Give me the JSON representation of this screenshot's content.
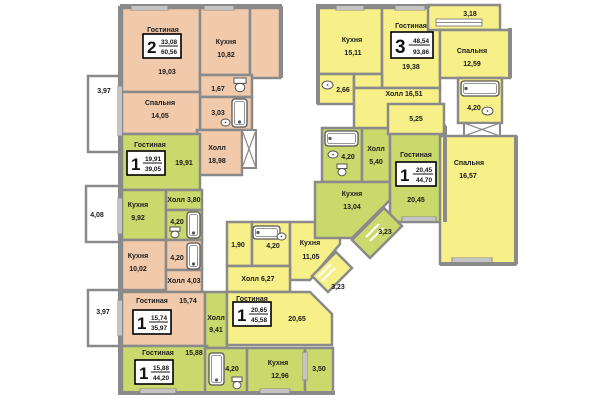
{
  "palette": {
    "wall": "#8a8a8a",
    "peach": "#f1caac",
    "green": "#c9d96b",
    "yellow": "#f7ef87",
    "white": "#ffffff",
    "text": "#1b1b1b",
    "badge_border": "#000000"
  },
  "rooms": [
    {
      "n": "balcony-397-top",
      "f": "white",
      "r": [
        88,
        76,
        32,
        76
      ],
      "labels": [
        {
          "t": "3,97",
          "x": 104,
          "y": 93
        }
      ]
    },
    {
      "n": "balcony-408",
      "f": "white",
      "r": [
        86,
        186,
        34,
        56
      ],
      "labels": [
        {
          "t": "4,08",
          "x": 97,
          "y": 217
        }
      ]
    },
    {
      "n": "balcony-397-bottom",
      "f": "white",
      "r": [
        88,
        290,
        32,
        56
      ],
      "labels": [
        {
          "t": "3,97",
          "x": 103,
          "y": 314
        }
      ]
    },
    {
      "n": "living-2room",
      "f": "peach",
      "r": [
        122,
        8,
        78,
        84
      ],
      "labels": [
        {
          "t": "Гостиная",
          "x": 163,
          "y": 32
        },
        {
          "t": "19,03",
          "x": 167,
          "y": 74
        }
      ]
    },
    {
      "n": "kitchen-2room",
      "f": "peach",
      "r": [
        200,
        8,
        50,
        67
      ],
      "labels": [
        {
          "t": "Кухня",
          "x": 226,
          "y": 44
        },
        {
          "t": "10,82",
          "x": 226,
          "y": 57
        }
      ]
    },
    {
      "n": "corner-2room",
      "f": "peach",
      "r": [
        250,
        8,
        30,
        70
      ],
      "labels": []
    },
    {
      "n": "wc-2room",
      "f": "peach",
      "r": [
        200,
        75,
        52,
        22
      ],
      "labels": [
        {
          "t": "1,67",
          "x": 218,
          "y": 91
        }
      ]
    },
    {
      "n": "bath-2room",
      "f": "peach",
      "r": [
        200,
        97,
        52,
        33
      ],
      "labels": [
        {
          "t": "3,03",
          "x": 218,
          "y": 115
        }
      ]
    },
    {
      "n": "bedroom-2room",
      "f": "peach",
      "r": [
        122,
        92,
        78,
        42
      ],
      "labels": [
        {
          "t": "Спальня",
          "x": 160,
          "y": 105
        },
        {
          "t": "14,05",
          "x": 160,
          "y": 118
        }
      ]
    },
    {
      "n": "hall-2room",
      "f": "peach",
      "r": [
        197,
        130,
        45,
        45
      ],
      "labels": [
        {
          "t": "Холл",
          "x": 217,
          "y": 150
        },
        {
          "t": "18,98",
          "x": 217,
          "y": 163
        }
      ]
    },
    {
      "n": "living-1room-a",
      "f": "green",
      "r": [
        122,
        134,
        78,
        56
      ],
      "labels": [
        {
          "t": "Гостиная",
          "x": 150,
          "y": 147
        },
        {
          "t": "19,91",
          "x": 184,
          "y": 165
        }
      ]
    },
    {
      "n": "kitchen-1room-a",
      "f": "green",
      "r": [
        122,
        190,
        44,
        50
      ],
      "labels": [
        {
          "t": "Кухня",
          "x": 138,
          "y": 207
        },
        {
          "t": "9,92",
          "x": 138,
          "y": 220
        }
      ]
    },
    {
      "n": "hall-1room-a",
      "f": "green",
      "r": [
        166,
        190,
        36,
        20
      ],
      "labels": [
        {
          "t": "Холл 3,80",
          "x": 184,
          "y": 202
        }
      ]
    },
    {
      "n": "bath-1room-a",
      "f": "green",
      "r": [
        166,
        210,
        36,
        30
      ],
      "labels": [
        {
          "t": "4,20",
          "x": 177,
          "y": 224
        }
      ]
    },
    {
      "n": "kitchen-1room-b",
      "f": "peach",
      "r": [
        122,
        240,
        44,
        50
      ],
      "labels": [
        {
          "t": "Кухня",
          "x": 138,
          "y": 258
        },
        {
          "t": "10,02",
          "x": 138,
          "y": 271
        }
      ]
    },
    {
      "n": "bath-1room-b",
      "f": "peach",
      "r": [
        166,
        240,
        36,
        30
      ],
      "labels": [
        {
          "t": "4,20",
          "x": 177,
          "y": 260
        }
      ]
    },
    {
      "n": "hall-1room-b",
      "f": "peach",
      "r": [
        166,
        270,
        36,
        22
      ],
      "labels": [
        {
          "t": "Холл 4,03",
          "x": 184,
          "y": 283
        }
      ]
    },
    {
      "n": "living-1room-b",
      "f": "peach",
      "r": [
        122,
        292,
        83,
        54
      ],
      "labels": [
        {
          "t": "Гостиная",
          "x": 152,
          "y": 303
        },
        {
          "t": "15,74",
          "x": 188,
          "y": 303
        }
      ]
    },
    {
      "n": "hall-1room-c",
      "f": "green",
      "r": [
        205,
        292,
        22,
        56
      ],
      "labels": [
        {
          "t": "Холл",
          "x": 216,
          "y": 320
        },
        {
          "t": "9,41",
          "x": 216,
          "y": 332
        }
      ]
    },
    {
      "n": "living-1room-c",
      "f": "green",
      "r": [
        122,
        346,
        85,
        47
      ],
      "labels": [
        {
          "t": "Гостиная",
          "x": 158,
          "y": 355
        },
        {
          "t": "15,88",
          "x": 194,
          "y": 355
        }
      ]
    },
    {
      "n": "bath-1room-c",
      "f": "green",
      "r": [
        205,
        348,
        42,
        45
      ],
      "labels": [
        {
          "t": "4,20",
          "x": 232,
          "y": 371
        }
      ]
    },
    {
      "n": "kitchen-1room-c",
      "f": "green",
      "r": [
        247,
        348,
        58,
        45
      ],
      "labels": [
        {
          "t": "Кухня",
          "x": 278,
          "y": 365
        },
        {
          "t": "12,96",
          "x": 280,
          "y": 378
        }
      ]
    },
    {
      "n": "balcony-350",
      "f": "green",
      "r": [
        305,
        348,
        28,
        45
      ],
      "labels": [
        {
          "t": "3,50",
          "x": 319,
          "y": 371
        }
      ]
    },
    {
      "n": "wc-1room-d",
      "f": "yellow",
      "r": [
        227,
        222,
        25,
        44
      ],
      "labels": [
        {
          "t": "1,90",
          "x": 238,
          "y": 247
        }
      ]
    },
    {
      "n": "bath-1room-d",
      "f": "yellow",
      "r": [
        252,
        222,
        38,
        44
      ],
      "labels": [
        {
          "t": "4,20",
          "x": 273,
          "y": 248
        }
      ]
    },
    {
      "n": "kitchen-1room-d",
      "f": "yellow",
      "p": [
        [
          290,
          222
        ],
        [
          340,
          222
        ],
        [
          340,
          244
        ],
        [
          310,
          280
        ],
        [
          290,
          280
        ]
      ],
      "labels": [
        {
          "t": "Кухня",
          "x": 310,
          "y": 245
        },
        {
          "t": "11,05",
          "x": 311,
          "y": 259
        }
      ]
    },
    {
      "n": "hall-1room-d",
      "f": "yellow",
      "r": [
        227,
        266,
        63,
        26
      ],
      "labels": [
        {
          "t": "Холл 6,27",
          "x": 258,
          "y": 281
        }
      ]
    },
    {
      "n": "living-1room-d",
      "f": "yellow",
      "p": [
        [
          227,
          292
        ],
        [
          310,
          292
        ],
        [
          332,
          314
        ],
        [
          332,
          345
        ],
        [
          227,
          345
        ]
      ],
      "labels": [
        {
          "t": "Гостиная",
          "x": 252,
          "y": 301
        },
        {
          "t": "20,65",
          "x": 297,
          "y": 321
        }
      ]
    },
    {
      "n": "balcony-323-yellow",
      "f": "yellow",
      "p": [
        [
          312,
          276
        ],
        [
          336,
          252
        ],
        [
          352,
          268
        ],
        [
          328,
          292
        ]
      ],
      "labels": [
        {
          "t": "3,23",
          "x": 338,
          "y": 289
        }
      ]
    },
    {
      "n": "bath-1room-e",
      "f": "green",
      "r": [
        322,
        128,
        40,
        54
      ],
      "labels": [
        {
          "t": "4,20",
          "x": 348,
          "y": 159
        }
      ]
    },
    {
      "n": "hall-1room-e",
      "f": "green",
      "r": [
        362,
        128,
        28,
        54
      ],
      "labels": [
        {
          "t": "Холл",
          "x": 376,
          "y": 151
        },
        {
          "t": "5,40",
          "x": 376,
          "y": 164
        }
      ]
    },
    {
      "n": "kitchen-1room-e",
      "f": "green",
      "p": [
        [
          315,
          182
        ],
        [
          390,
          182
        ],
        [
          390,
          200
        ],
        [
          352,
          238
        ],
        [
          315,
          238
        ]
      ],
      "labels": [
        {
          "t": "Кухня",
          "x": 352,
          "y": 196
        },
        {
          "t": "13,04",
          "x": 352,
          "y": 209
        }
      ]
    },
    {
      "n": "living-1room-e",
      "f": "green",
      "r": [
        390,
        126,
        55,
        96
      ],
      "labels": [
        {
          "t": "Гостиная",
          "x": 416,
          "y": 157
        },
        {
          "t": "20,45",
          "x": 416,
          "y": 202
        }
      ]
    },
    {
      "n": "balcony-323-green",
      "f": "green",
      "p": [
        [
          352,
          240
        ],
        [
          384,
          208
        ],
        [
          402,
          226
        ],
        [
          370,
          258
        ]
      ],
      "labels": [
        {
          "t": "3,23",
          "x": 385,
          "y": 234
        }
      ]
    },
    {
      "n": "kitchen-3room",
      "f": "yellow",
      "r": [
        318,
        8,
        64,
        66
      ],
      "labels": [
        {
          "t": "Кухня",
          "x": 352,
          "y": 42
        },
        {
          "t": "15,11",
          "x": 353,
          "y": 55
        }
      ]
    },
    {
      "n": "living-3room",
      "f": "yellow",
      "r": [
        382,
        8,
        58,
        80
      ],
      "labels": [
        {
          "t": "Гостиная",
          "x": 411,
          "y": 28
        },
        {
          "t": "19,38",
          "x": 411,
          "y": 69
        }
      ]
    },
    {
      "n": "balcony-318",
      "f": "yellow",
      "r": [
        428,
        5,
        72,
        25
      ],
      "labels": [
        {
          "t": "3,18",
          "x": 470,
          "y": 16
        }
      ]
    },
    {
      "n": "bedroom-3room-a",
      "f": "yellow",
      "r": [
        440,
        30,
        70,
        48
      ],
      "labels": [
        {
          "t": "Спальня",
          "x": 472,
          "y": 53
        },
        {
          "t": "12,59",
          "x": 472,
          "y": 66
        }
      ]
    },
    {
      "n": "wc-3room",
      "f": "yellow",
      "r": [
        318,
        74,
        36,
        30
      ],
      "labels": [
        {
          "t": "2,66",
          "x": 343,
          "y": 92
        }
      ]
    },
    {
      "n": "hall-3room-upper",
      "f": "yellow",
      "r": [
        354,
        74,
        28,
        14
      ],
      "labels": []
    },
    {
      "n": "hall-3room",
      "f": "yellow",
      "r": [
        354,
        88,
        86,
        40
      ],
      "labels": [
        {
          "t": "Холл 16,51",
          "x": 404,
          "y": 96
        }
      ]
    },
    {
      "n": "corridor-3room",
      "f": "yellow",
      "r": [
        388,
        104,
        56,
        30
      ],
      "labels": [
        {
          "t": "5,25",
          "x": 416,
          "y": 121
        }
      ]
    },
    {
      "n": "bath-3room",
      "f": "yellow",
      "r": [
        458,
        78,
        44,
        45
      ],
      "labels": [
        {
          "t": "4,20",
          "x": 474,
          "y": 110
        }
      ]
    },
    {
      "n": "bedroom-3room-b",
      "f": "yellow",
      "r": [
        440,
        136,
        76,
        128
      ],
      "labels": [
        {
          "t": "Спальня",
          "x": 469,
          "y": 165
        },
        {
          "t": "16,57",
          "x": 468,
          "y": 178
        }
      ]
    }
  ],
  "badges": [
    {
      "r": [
        143,
        34,
        38,
        24
      ],
      "num": "2",
      "top": "33,08",
      "bot": "60,56"
    },
    {
      "r": [
        127,
        151,
        38,
        24
      ],
      "num": "1",
      "top": "19,91",
      "bot": "39,05"
    },
    {
      "r": [
        133,
        310,
        38,
        24
      ],
      "num": "1",
      "top": "15,74",
      "bot": "35,97"
    },
    {
      "r": [
        135,
        360,
        38,
        24
      ],
      "num": "1",
      "top": "15,88",
      "bot": "44,20"
    },
    {
      "r": [
        233,
        302,
        38,
        24
      ],
      "num": "1",
      "top": "20,65",
      "bot": "45,58"
    },
    {
      "r": [
        396,
        162,
        40,
        24
      ],
      "num": "1",
      "top": "20,45",
      "bot": "44,70"
    },
    {
      "r": [
        391,
        32,
        42,
        26
      ],
      "num": "3",
      "top": "48,54",
      "bot": "93,86"
    }
  ],
  "walls": [
    [
      120,
      6,
      282,
      6
    ],
    [
      120,
      6,
      120,
      395
    ],
    [
      120,
      393,
      335,
      393
    ],
    [
      316,
      6,
      430,
      6
    ],
    [
      318,
      6,
      318,
      104
    ],
    [
      281,
      6,
      281,
      78
    ],
    [
      510,
      28,
      510,
      78
    ],
    [
      516,
      136,
      516,
      264
    ],
    [
      440,
      264,
      516,
      264
    ],
    [
      445,
      126,
      445,
      222
    ]
  ],
  "stairs": [
    [
      242,
      130,
      14,
      38
    ],
    [
      464,
      123,
      36,
      13
    ]
  ],
  "fixtures": [
    {
      "t": "tub-v",
      "x": 232,
      "y": 99,
      "w": 15,
      "h": 28
    },
    {
      "t": "tub-v",
      "x": 187,
      "y": 212,
      "w": 13,
      "h": 26
    },
    {
      "t": "tub-v",
      "x": 187,
      "y": 243,
      "w": 13,
      "h": 26
    },
    {
      "t": "tub-v",
      "x": 209,
      "y": 353,
      "w": 15,
      "h": 32
    },
    {
      "t": "tub-h",
      "x": 253,
      "y": 226,
      "w": 27,
      "h": 13
    },
    {
      "t": "tub-h",
      "x": 325,
      "y": 131,
      "w": 33,
      "h": 15
    },
    {
      "t": "tub-h",
      "x": 461,
      "y": 81,
      "w": 38,
      "h": 15
    },
    {
      "t": "toilet",
      "x": 234,
      "y": 78,
      "w": 12,
      "h": 14
    },
    {
      "t": "toilet",
      "x": 170,
      "y": 227,
      "w": 10,
      "h": 11
    },
    {
      "t": "toilet",
      "x": 232,
      "y": 377,
      "w": 10,
      "h": 12
    },
    {
      "t": "toilet",
      "x": 337,
      "y": 164,
      "w": 10,
      "h": 12
    },
    {
      "t": "sink",
      "x": 221,
      "y": 119,
      "w": 9,
      "h": 7
    },
    {
      "t": "sink",
      "x": 277,
      "y": 233,
      "w": 9,
      "h": 7
    },
    {
      "t": "sink",
      "x": 328,
      "y": 151,
      "w": 10,
      "h": 7
    },
    {
      "t": "sink",
      "x": 322,
      "y": 81,
      "w": 11,
      "h": 8
    },
    {
      "t": "sink",
      "x": 482,
      "y": 107,
      "w": 11,
      "h": 8
    }
  ],
  "windows": [
    [
      131,
      6,
      37,
      4
    ],
    [
      204,
      6,
      30,
      4
    ],
    [
      336,
      6,
      28,
      4
    ],
    [
      395,
      6,
      30,
      4
    ],
    [
      436,
      19,
      46,
      7
    ],
    [
      118,
      86,
      4,
      50
    ],
    [
      118,
      198,
      4,
      36
    ],
    [
      118,
      300,
      4,
      36
    ],
    [
      303,
      352,
      4,
      28
    ],
    [
      402,
      217,
      34,
      4
    ],
    [
      452,
      258,
      40,
      4
    ],
    [
      140,
      389,
      36,
      4
    ],
    [
      260,
      389,
      30,
      4
    ]
  ],
  "hatches": [
    [
      318,
      277,
      331,
      264
    ],
    [
      322,
      281,
      335,
      268
    ],
    [
      366,
      237,
      379,
      224
    ],
    [
      370,
      241,
      383,
      228
    ]
  ]
}
